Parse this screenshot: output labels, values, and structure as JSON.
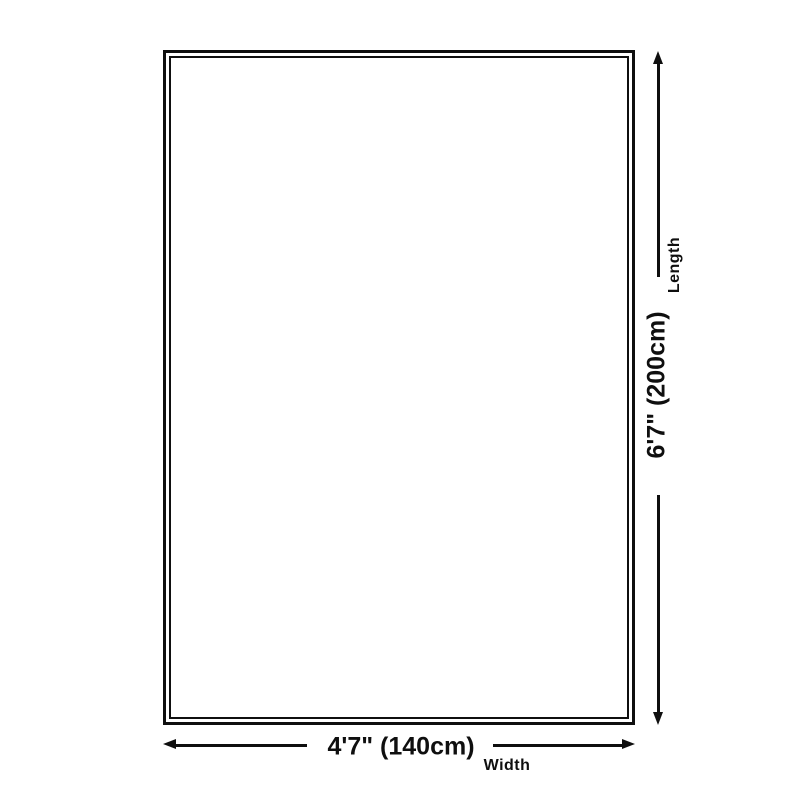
{
  "dimensions": {
    "length": {
      "value": "6'7\" (200cm)",
      "label": "Length"
    },
    "width": {
      "value": "4'7\" (140cm)",
      "label": "Width"
    }
  },
  "colors": {
    "line": "#0f0f0f",
    "background": "#ffffff"
  }
}
